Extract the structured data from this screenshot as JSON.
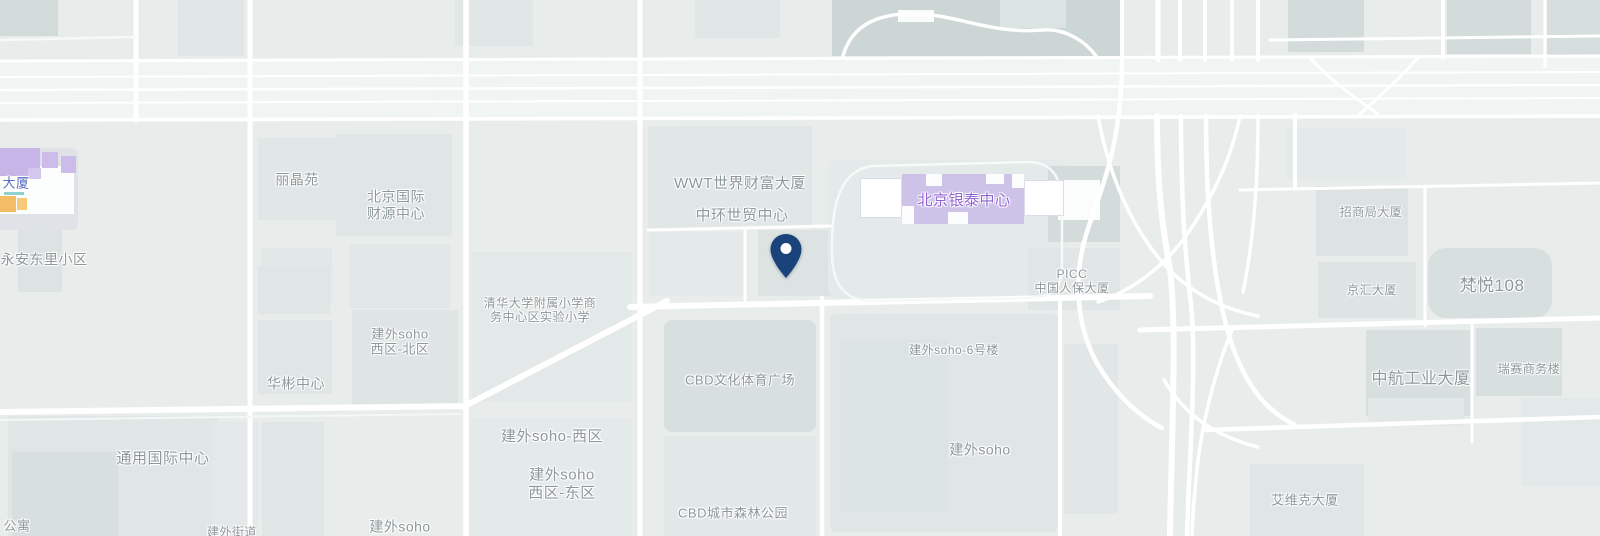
{
  "map": {
    "background": "#e8edec",
    "road_color": "#ffffff",
    "pin": {
      "x": 786,
      "tip_y": 278,
      "c": "#1a437c"
    },
    "labels": [
      {
        "t": "永安东里小区",
        "x": 44,
        "y": 260,
        "s": 14
      },
      {
        "t": "丽晶苑",
        "x": 297,
        "y": 180,
        "s": 14
      },
      {
        "lines": [
          "北京国际",
          "财源中心"
        ],
        "x": 396,
        "y": 205,
        "s": 14
      },
      {
        "t": "WWT世界财富大厦",
        "x": 740,
        "y": 184,
        "s": 15
      },
      {
        "t": "中环世贸中心",
        "x": 742,
        "y": 216,
        "s": 15
      },
      {
        "t": "北京银泰中心",
        "x": 964,
        "y": 201,
        "s": 15,
        "c": "#9263d0"
      },
      {
        "lines": [
          "PICC",
          "中国人保大厦"
        ],
        "x": 1072,
        "y": 281,
        "s": 12
      },
      {
        "t": "招商局大厦",
        "x": 1371,
        "y": 212,
        "s": 12
      },
      {
        "t": "京汇大厦",
        "x": 1372,
        "y": 290,
        "s": 12
      },
      {
        "t": "梵悦108",
        "x": 1492,
        "y": 286,
        "s": 17
      },
      {
        "t": "中航工业大厦",
        "x": 1421,
        "y": 380,
        "s": 16
      },
      {
        "t": "瑞赛商务楼",
        "x": 1529,
        "y": 369,
        "s": 12
      },
      {
        "t": "艾维克大厦",
        "x": 1305,
        "y": 500,
        "s": 13
      },
      {
        "t": "建外soho-6号楼",
        "x": 954,
        "y": 350,
        "s": 12
      },
      {
        "t": "建外soho",
        "x": 980,
        "y": 450,
        "s": 14
      },
      {
        "t": "CBD文化体育广场",
        "x": 740,
        "y": 380,
        "s": 13
      },
      {
        "t": "CBD城市森林公园",
        "x": 733,
        "y": 513,
        "s": 13
      },
      {
        "lines": [
          "清华大学附属小学商",
          "务中心区实验小学"
        ],
        "x": 540,
        "y": 310,
        "s": 12
      },
      {
        "lines": [
          "建外soho",
          "西区-北区"
        ],
        "x": 400,
        "y": 342,
        "s": 13
      },
      {
        "t": "华彬中心",
        "x": 296,
        "y": 384,
        "s": 14
      },
      {
        "t": "建外soho-西区",
        "x": 552,
        "y": 437,
        "s": 15
      },
      {
        "lines": [
          "建外soho",
          "西区-东区"
        ],
        "x": 562,
        "y": 484,
        "s": 15
      },
      {
        "t": "通用国际中心",
        "x": 163,
        "y": 459,
        "s": 15
      },
      {
        "t": "建外soho",
        "x": 400,
        "y": 527,
        "s": 14
      },
      {
        "t": "建外街道",
        "x": 232,
        "y": 532,
        "s": 12
      },
      {
        "t": "公寓",
        "x": 17,
        "y": 526,
        "s": 13
      },
      {
        "t": "大厦",
        "x": 16,
        "y": 183,
        "s": 13,
        "c": "#5a6ec2"
      }
    ],
    "buildings": [
      {
        "x": 0,
        "y": 0,
        "w": 58,
        "h": 36,
        "c": "#d2dbda"
      },
      {
        "x": 178,
        "y": 0,
        "w": 66,
        "h": 56,
        "c": "#dfe6e5"
      },
      {
        "x": 455,
        "y": 0,
        "w": 78,
        "h": 46,
        "c": "#e1e7e6"
      },
      {
        "x": 695,
        "y": 0,
        "w": 85,
        "h": 38,
        "c": "#e0e7e6"
      },
      {
        "x": 832,
        "y": 0,
        "w": 288,
        "h": 56,
        "c": "#ccd6d5"
      },
      {
        "x": 898,
        "y": 10,
        "w": 36,
        "h": 12,
        "c": "#fafcfb"
      },
      {
        "x": 1000,
        "y": 0,
        "w": 66,
        "h": 28,
        "c": "#dce4e3"
      },
      {
        "x": 1288,
        "y": 0,
        "w": 76,
        "h": 52,
        "c": "#d3dcdb"
      },
      {
        "x": 1447,
        "y": 0,
        "w": 84,
        "h": 54,
        "c": "#d3dcdb"
      },
      {
        "x": 1543,
        "y": 0,
        "w": 57,
        "h": 64,
        "c": "#d6dedd"
      },
      {
        "x": 258,
        "y": 138,
        "w": 78,
        "h": 82,
        "c": "#e1e7e6"
      },
      {
        "x": 336,
        "y": 134,
        "w": 116,
        "h": 102,
        "c": "#dfe6e5"
      },
      {
        "x": 262,
        "y": 248,
        "w": 70,
        "h": 58,
        "c": "#e2e8e7"
      },
      {
        "x": 350,
        "y": 244,
        "w": 100,
        "h": 64,
        "c": "#e2e8e7"
      },
      {
        "x": 258,
        "y": 266,
        "w": 72,
        "h": 48,
        "c": "#e0e6e5"
      },
      {
        "x": 258,
        "y": 320,
        "w": 74,
        "h": 74,
        "c": "#dfe6e5"
      },
      {
        "x": 352,
        "y": 310,
        "w": 106,
        "h": 96,
        "c": "#dee5e4"
      },
      {
        "x": 472,
        "y": 252,
        "w": 160,
        "h": 150,
        "c": "#e3e9e8"
      },
      {
        "x": 648,
        "y": 126,
        "w": 164,
        "h": 102,
        "c": "#e0e7e6"
      },
      {
        "x": 650,
        "y": 232,
        "w": 96,
        "h": 64,
        "c": "#e3e9e8"
      },
      {
        "x": 758,
        "y": 230,
        "w": 76,
        "h": 66,
        "c": "#dce3e2"
      },
      {
        "x": 828,
        "y": 160,
        "w": 240,
        "h": 138,
        "c": "#e4eae9",
        "r": 10
      },
      {
        "x": 1048,
        "y": 166,
        "w": 72,
        "h": 76,
        "c": "#d3dcdb"
      },
      {
        "x": 1058,
        "y": 180,
        "w": 42,
        "h": 40,
        "c": "#fbfdfc"
      },
      {
        "x": 1028,
        "y": 248,
        "w": 92,
        "h": 62,
        "c": "#e0e6e5"
      },
      {
        "x": 664,
        "y": 320,
        "w": 152,
        "h": 112,
        "c": "#d8e0df",
        "r": 8
      },
      {
        "x": 664,
        "y": 436,
        "w": 152,
        "h": 100,
        "c": "#e2e8e7"
      },
      {
        "x": 830,
        "y": 314,
        "w": 228,
        "h": 218,
        "c": "#dfe6e5",
        "r": 6
      },
      {
        "x": 840,
        "y": 340,
        "w": 108,
        "h": 172,
        "c": "#dce4e3"
      },
      {
        "x": 1064,
        "y": 344,
        "w": 54,
        "h": 170,
        "c": "#e0e7e6"
      },
      {
        "x": 1316,
        "y": 186,
        "w": 92,
        "h": 70,
        "c": "#dce3e2"
      },
      {
        "x": 1318,
        "y": 262,
        "w": 98,
        "h": 56,
        "c": "#dde4e3"
      },
      {
        "x": 1428,
        "y": 248,
        "w": 124,
        "h": 70,
        "c": "#d8e0df",
        "r": 18
      },
      {
        "x": 1366,
        "y": 330,
        "w": 104,
        "h": 86,
        "c": "#d8e0df"
      },
      {
        "x": 1476,
        "y": 328,
        "w": 86,
        "h": 68,
        "c": "#d8e0df"
      },
      {
        "x": 1368,
        "y": 398,
        "w": 96,
        "h": 28,
        "c": "#e2e8e7"
      },
      {
        "x": 1522,
        "y": 398,
        "w": 78,
        "h": 88,
        "c": "#e3e9e8"
      },
      {
        "x": 1250,
        "y": 464,
        "w": 114,
        "h": 72,
        "c": "#dfe6e5"
      },
      {
        "x": 8,
        "y": 416,
        "w": 210,
        "h": 120,
        "c": "#e0e6e5"
      },
      {
        "x": 12,
        "y": 452,
        "w": 106,
        "h": 84,
        "c": "#d8e0df"
      },
      {
        "x": 212,
        "y": 422,
        "w": 46,
        "h": 114,
        "c": "#e3e9e8"
      },
      {
        "x": 262,
        "y": 422,
        "w": 62,
        "h": 114,
        "c": "#e0e6e5"
      },
      {
        "x": 18,
        "y": 226,
        "w": 44,
        "h": 66,
        "c": "#dce3e2"
      },
      {
        "x": 470,
        "y": 418,
        "w": 162,
        "h": 118,
        "c": "#e4eae9"
      },
      {
        "x": 1286,
        "y": 128,
        "w": 120,
        "h": 52,
        "c": "#e4eae9"
      }
    ],
    "landmarks": {
      "mall": [
        {
          "x": -10,
          "y": 148,
          "w": 88,
          "h": 82,
          "c": "#dfe3e8",
          "r": 6
        },
        {
          "x": 0,
          "y": 166,
          "w": 74,
          "h": 48,
          "c": "#fcfdfd"
        },
        {
          "x": -10,
          "y": 148,
          "w": 50,
          "h": 28,
          "c": "#c7b5e7"
        },
        {
          "x": 42,
          "y": 152,
          "w": 16,
          "h": 16,
          "c": "#cdbcea"
        },
        {
          "x": 61,
          "y": 156,
          "w": 15,
          "h": 17,
          "c": "#cdbcea"
        },
        {
          "x": 28,
          "y": 168,
          "w": 13,
          "h": 11,
          "c": "#d5c6ee"
        },
        {
          "x": 4,
          "y": 192,
          "w": 20,
          "h": 3,
          "c": "#8fd2cd"
        },
        {
          "x": -6,
          "y": 196,
          "w": 22,
          "h": 16,
          "c": "#f3bd66"
        },
        {
          "x": 17,
          "y": 198,
          "w": 10,
          "h": 12,
          "c": "#f6ca79"
        }
      ],
      "yintai": [
        {
          "x": 902,
          "y": 174,
          "w": 122,
          "h": 50,
          "c": "#cdc2e8"
        },
        {
          "x": 926,
          "y": 174,
          "w": 16,
          "h": 12,
          "c": "#fbfcfd"
        },
        {
          "x": 986,
          "y": 174,
          "w": 18,
          "h": 10,
          "c": "#fbfcfd"
        },
        {
          "x": 902,
          "y": 206,
          "w": 12,
          "h": 18,
          "c": "#fbfcfd"
        },
        {
          "x": 948,
          "y": 212,
          "w": 20,
          "h": 12,
          "c": "#fbfcfd"
        },
        {
          "x": 1012,
          "y": 174,
          "w": 12,
          "h": 14,
          "c": "#fbfcfd"
        },
        {
          "x": 860,
          "y": 178,
          "w": 40,
          "h": 38,
          "c": "#ffffff",
          "b": "#d9dee8"
        },
        {
          "x": 1024,
          "y": 180,
          "w": 38,
          "h": 34,
          "c": "#ffffff",
          "b": "#d9dee8"
        }
      ]
    },
    "roads": {
      "avenue": {
        "d": "M0,60 L1600,55 L1600,118 L0,122 Z",
        "c": "#f0f4f3"
      },
      "lines": [
        {
          "d": "M0,61 L1600,56",
          "w": 3
        },
        {
          "d": "M0,77 L1600,72",
          "w": 2
        },
        {
          "d": "M0,90 L1600,85",
          "w": 2.5
        },
        {
          "d": "M0,103 L1600,98",
          "w": 2
        },
        {
          "d": "M0,120 L1600,116",
          "w": 3.5
        },
        {
          "d": "M136,0 V120",
          "w": 5
        },
        {
          "d": "M250,0 V536",
          "w": 5
        },
        {
          "d": "M466,0 V536",
          "w": 5.5
        },
        {
          "d": "M640,0 V536",
          "w": 5
        },
        {
          "d": "M822,298 V536",
          "w": 4.5
        },
        {
          "d": "M1060,298 V536",
          "w": 4
        },
        {
          "d": "M745,228 V300",
          "w": 3
        },
        {
          "d": "M648,230 L832,226",
          "w": 3
        },
        {
          "d": "M630,307 L1150,296",
          "w": 6
        },
        {
          "d": "M463,407 L667,301",
          "w": 6
        },
        {
          "d": "M0,412 L466,406",
          "w": 6
        },
        {
          "d": "M0,420 L460,414",
          "w": 2,
          "c": "#f3f7f6"
        },
        {
          "d": "M1140,330 L1600,318",
          "w": 5
        },
        {
          "d": "M1205,430 L1600,417",
          "w": 4.5
        },
        {
          "d": "M1425,186 V326",
          "w": 3
        },
        {
          "d": "M1472,324 V442",
          "w": 3
        },
        {
          "d": "M1240,190 L1600,183",
          "w": 3
        },
        {
          "d": "M1295,115 V188",
          "w": 4
        },
        {
          "d": "M1122,0 V58",
          "w": 4
        },
        {
          "d": "M1158,0 V60",
          "w": 5
        },
        {
          "d": "M1180,0 V60",
          "w": 4
        },
        {
          "d": "M1205,0 V60",
          "w": 4
        },
        {
          "d": "M1232,0 V60",
          "w": 4
        },
        {
          "d": "M1258,0 V60",
          "w": 4
        },
        {
          "d": "M1443,0 V58",
          "w": 4
        },
        {
          "d": "M1545,0 V66",
          "w": 3.5
        },
        {
          "d": "M1270,40 L1600,36",
          "w": 3
        },
        {
          "d": "M1310,58 C1330,80 1352,96 1378,114",
          "w": 3
        },
        {
          "d": "M1418,58 C1398,80 1380,96 1360,114",
          "w": 3
        },
        {
          "d": "M843,56 C852,24 880,12 920,14 C960,16 992,34 1042,30 C1066,28 1086,42 1096,56",
          "w": 3.5
        },
        {
          "d": "M1157,116 C1157,190 1163,230 1170,270 C1177,330 1172,420 1170,536",
          "w": 6
        },
        {
          "d": "M1181,116 C1181,210 1186,260 1191,305 C1197,365 1189,460 1187,536",
          "w": 4.5
        },
        {
          "d": "M1206,116 C1206,200 1212,285 1232,345 C1247,388 1268,412 1295,425",
          "w": 4.5
        },
        {
          "d": "M1122,60 C1122,150 1098,195 1086,235 C1072,282 1078,330 1098,365 C1118,398 1142,418 1162,428",
          "w": 4.5
        },
        {
          "d": "M1240,116 C1230,165 1208,205 1183,240 C1158,272 1128,292 1098,302",
          "w": 3.5
        },
        {
          "d": "M1098,116 C1108,170 1128,222 1162,262 C1192,296 1228,310 1258,316",
          "w": 3.5
        },
        {
          "d": "M1258,116 C1258,180 1254,240 1243,292",
          "w": 3.5
        },
        {
          "d": "M1232,330 C1214,374 1200,430 1196,480 C1193,510 1192,522 1192,536",
          "w": 3.5
        },
        {
          "d": "M1164,380 C1184,414 1214,436 1258,447",
          "w": 3.5
        },
        {
          "d": "M832,244 C832,198 844,168 874,166 L1028,162 C1054,162 1062,180 1062,206 L1062,268 C1062,292 1050,298 1022,298 L872,301 C846,301 832,286 832,252 Z",
          "w": 2.5,
          "c": "#f6f9f8"
        },
        {
          "d": "M0,40 L136,37",
          "w": 2.5,
          "c": "#f6f9f8"
        }
      ]
    }
  }
}
